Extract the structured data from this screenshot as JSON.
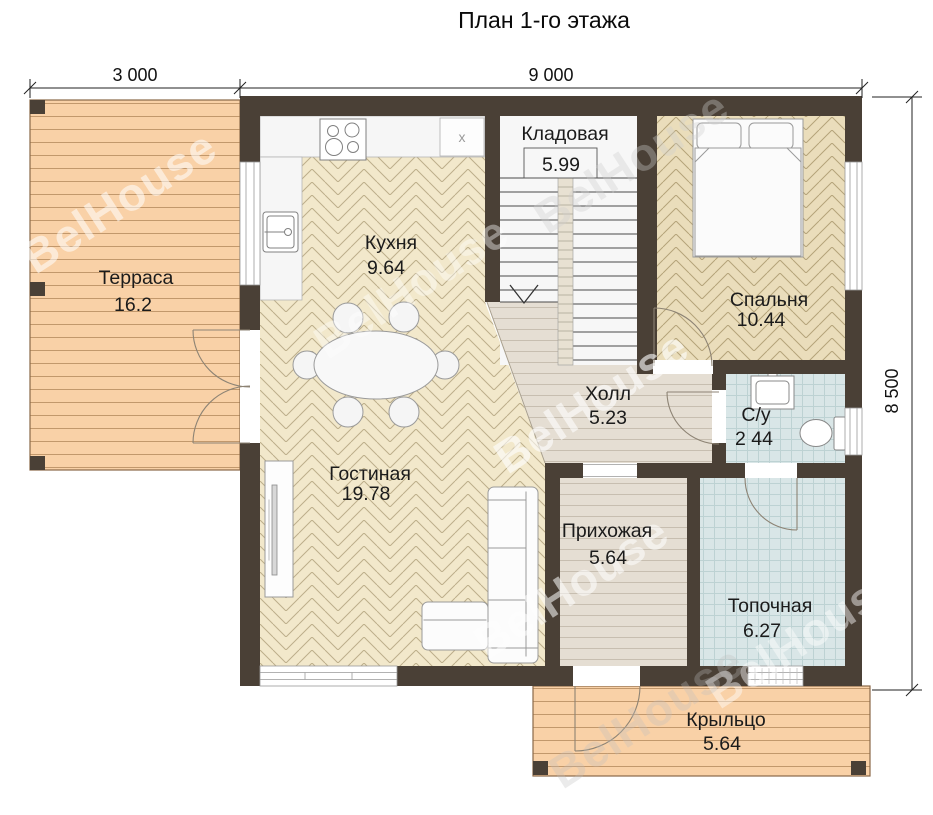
{
  "title": "План 1-го этажа",
  "watermark": "BelHouse",
  "dimensions": {
    "terrace_width": "3 000",
    "house_width": "9 000",
    "house_depth": "8 500"
  },
  "rooms": {
    "terrace": {
      "name": "Терраса",
      "area": "16.2"
    },
    "kitchen": {
      "name": "Кухня",
      "area": "9.64"
    },
    "storage": {
      "name": "Кладовая",
      "area": "5.99"
    },
    "bedroom": {
      "name": "Спальня",
      "area": "10.44"
    },
    "hall": {
      "name": "Холл",
      "area": "5.23"
    },
    "bathroom": {
      "name": "С/у",
      "area": "2 44"
    },
    "living_room": {
      "name": "Гостиная",
      "area": "19.78"
    },
    "entry": {
      "name": "Прихожая",
      "area": "5.64"
    },
    "boiler_room": {
      "name": "Топочная",
      "area": "6.27"
    },
    "porch": {
      "name": "Крыльцо",
      "area": "5.64"
    }
  },
  "fixtures": {
    "appliance_mark": "x"
  },
  "colors": {
    "wall": "#4a4036",
    "deck": "#f9d1a7",
    "parquet_light": "#f2e8cb",
    "parquet_tan": "#eaddbb",
    "plank_gray": "#e5ded3",
    "tile_blue": "#d9e6e7"
  }
}
